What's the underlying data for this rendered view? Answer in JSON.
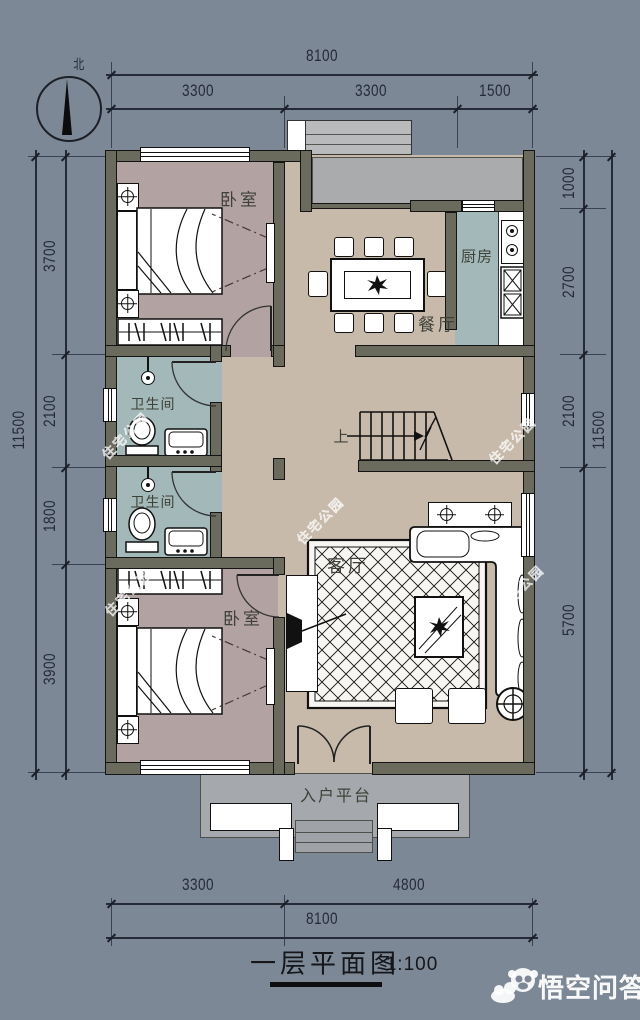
{
  "colors": {
    "background": "#7d8897",
    "wall": "#6a6a5d",
    "floor_main": "#c8baab",
    "floor_bedroom": "#b3a2a2",
    "floor_wet": "#a3b8b8",
    "porch_gray": "#a9abad",
    "platform_gray": "#a5a8ac",
    "ink": "#141414",
    "dim_text": "#252b36"
  },
  "compass": {
    "north_label": "北"
  },
  "dimensions": {
    "top": {
      "total": "8100",
      "segments": [
        "3300",
        "3300",
        "1500"
      ]
    },
    "bottom": {
      "total": "8100",
      "segments": [
        "3300",
        "4800"
      ]
    },
    "left": {
      "total": "11500",
      "segments": [
        "3700",
        "2100",
        "1800",
        "3900"
      ]
    },
    "right": {
      "total": "11500",
      "segments": [
        "1000",
        "2700",
        "2100",
        "5700"
      ]
    }
  },
  "rooms": {
    "bedroom_top": {
      "label": "卧室"
    },
    "dining": {
      "label": "餐厅"
    },
    "kitchen": {
      "label": "厨房"
    },
    "bath_upper": {
      "label": "卫生间"
    },
    "bath_lower": {
      "label": "卫生间"
    },
    "living": {
      "label": "客厅"
    },
    "bedroom_bottom": {
      "label": "卧室"
    },
    "stairs": {
      "label": "上"
    },
    "entry": {
      "label": "入户平台"
    }
  },
  "titleblock": {
    "title": "一层平面图",
    "scale": "1:100"
  },
  "watermarks": {
    "tile": "住宅公园",
    "brand": "悟空问答"
  }
}
